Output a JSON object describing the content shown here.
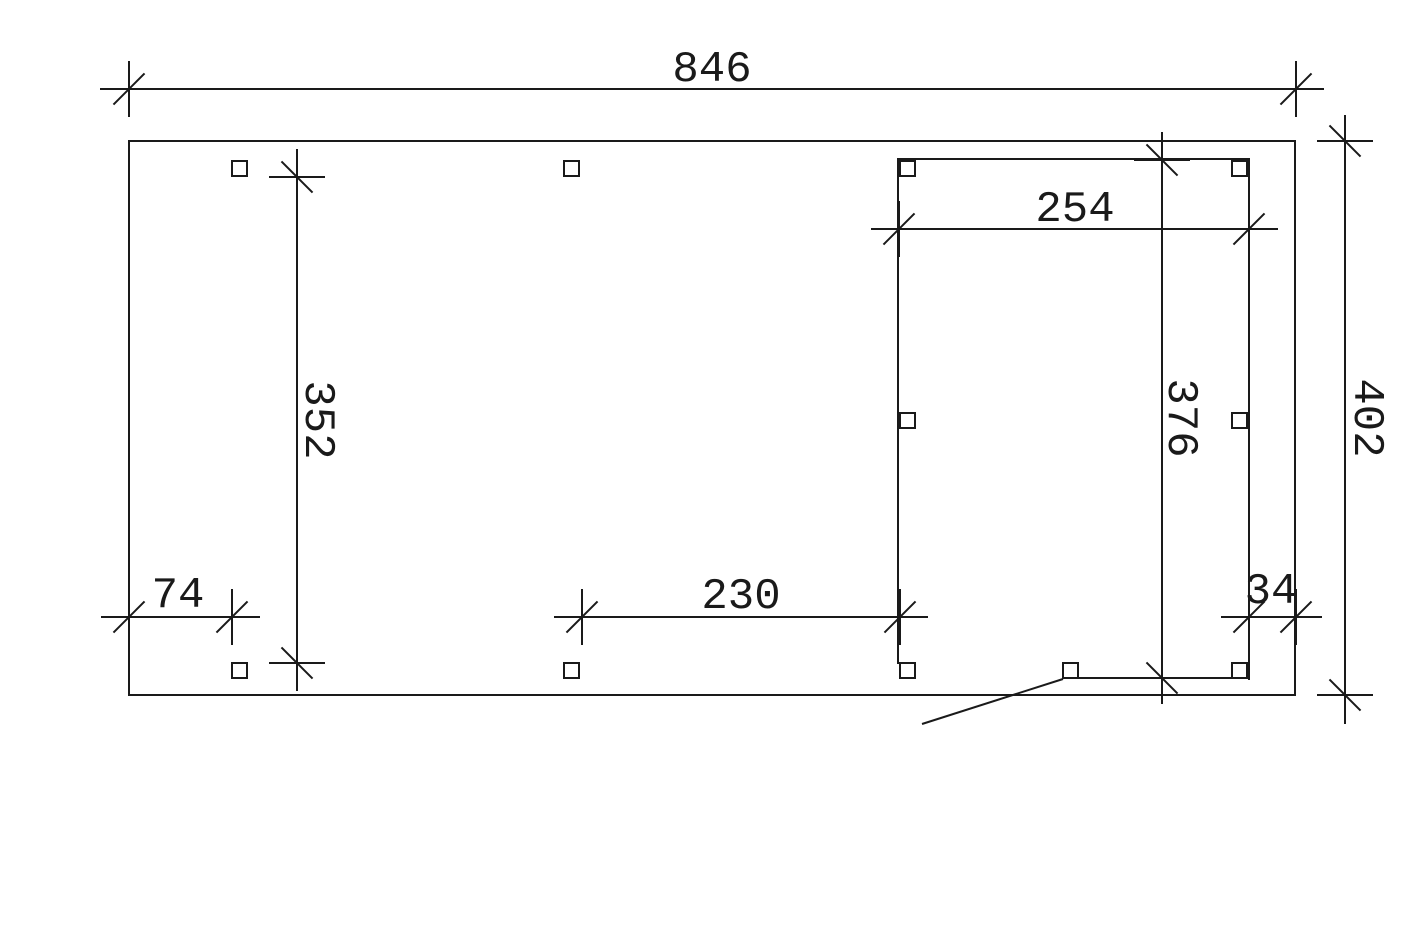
{
  "drawing": {
    "type": "technical-floor-plan",
    "colors": {
      "background": "#ffffff",
      "line": "#1a1a1a"
    },
    "dimensions": {
      "total_width": "846",
      "inner_bay_width": "254",
      "left_depth": "352",
      "inner_bay_depth": "376",
      "total_depth": "402",
      "left_offset": "74",
      "middle_span": "230",
      "right_offset": "34"
    },
    "post_count": 11
  }
}
